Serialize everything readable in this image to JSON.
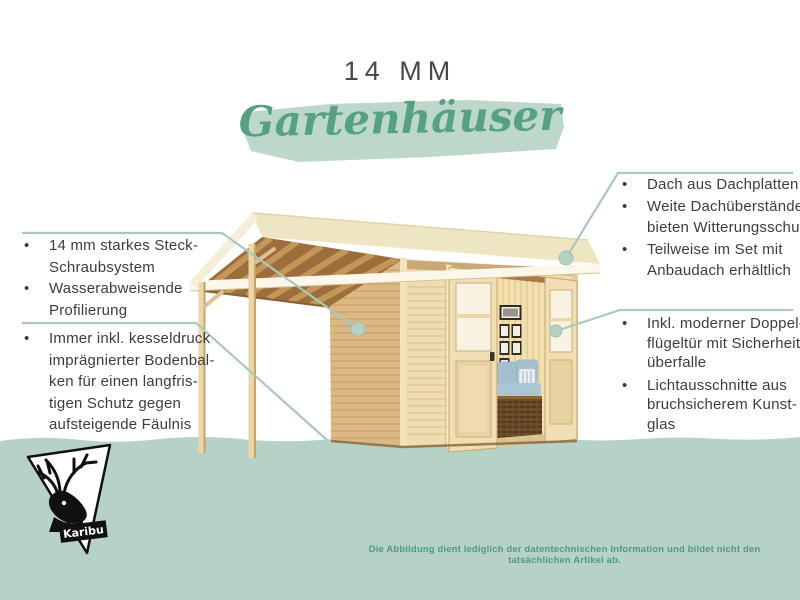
{
  "ui": {
    "bullet": "•"
  },
  "header": {
    "title": "14 MM",
    "subtitle": "Gartenhäuser"
  },
  "features_left": [
    {
      "name": "wall-system",
      "items": [
        {
          "lines": [
            "14 mm starkes Steck-",
            "Schraubsystem"
          ]
        },
        {
          "lines": [
            "Wasserabweisende",
            "Profilierung"
          ]
        }
      ]
    },
    {
      "name": "floor-beams",
      "items": [
        {
          "lines": [
            "Immer inkl. kesseldruck",
            "imprägnierter Bodenbal-",
            "ken für einen langfris-",
            "tigen Schutz gegen",
            "aufsteigende Fäulnis"
          ]
        }
      ]
    }
  ],
  "features_right": [
    {
      "name": "roof",
      "items": [
        {
          "lines": [
            "Dach aus Dachplatten"
          ]
        },
        {
          "lines": [
            "Weite Dachüberstände",
            "bieten Witterungsschutz"
          ]
        },
        {
          "lines": [
            "Teilweise im Set mit",
            "Anbaudach erhältlich"
          ]
        }
      ]
    },
    {
      "name": "door",
      "items": [
        {
          "lines": [
            "Inkl. moderner Doppel-",
            "flügeltür mit Sicherheits-",
            "überfalle"
          ]
        },
        {
          "lines": [
            "Lichtausschnitte aus",
            "bruchsicherem Kunst-",
            "glas"
          ]
        }
      ]
    }
  ],
  "logo": {
    "brand": "Karibu"
  },
  "footer": {
    "disclaimer": "Die Abbildung dient lediglich der datentechnischen Information und bildet nicht den tatsächlichen Artikel ab."
  },
  "illustration": {
    "subject": "Gartenhaus mit Anbaudach, Flachdach und offener Doppelflügeltür"
  },
  "colors": {
    "accent_green": "#55a184",
    "band_green": "#b6d2c6",
    "leader_green": "#a8c9bb",
    "text_dark": "#3a3d3f",
    "disclaimer_green": "#4e9b7d",
    "wood_light": "#efddb2"
  }
}
